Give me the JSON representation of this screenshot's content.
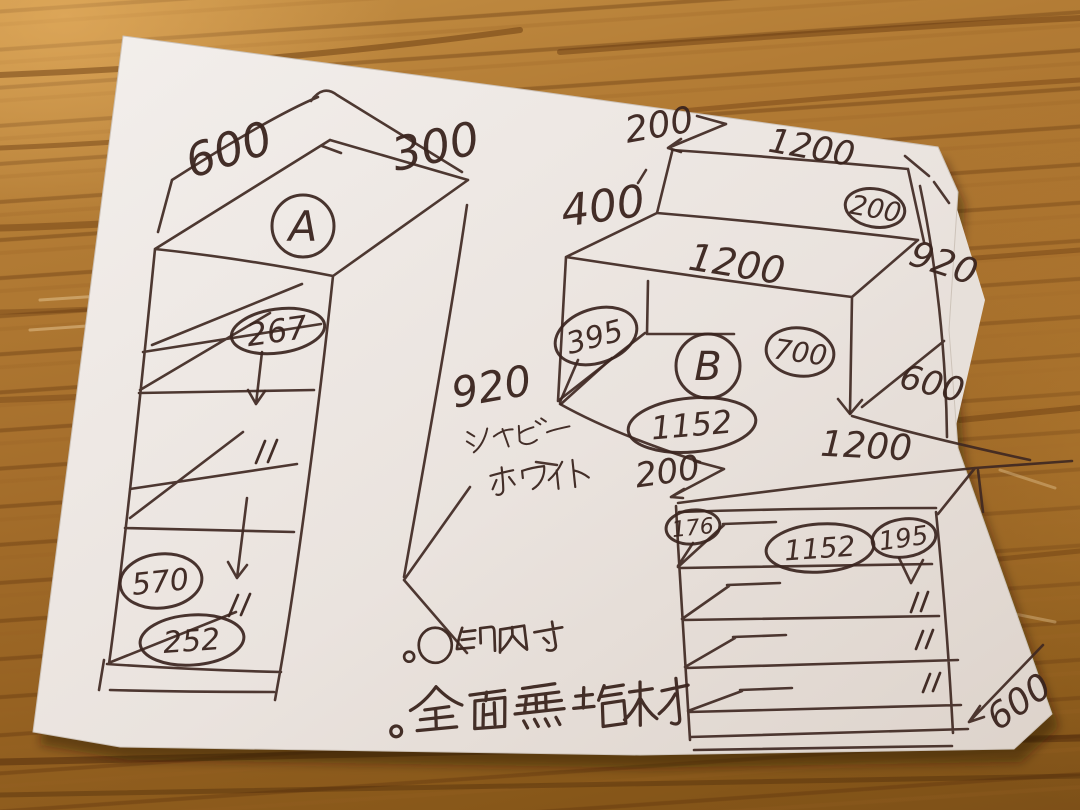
{
  "scene": {
    "ink_color": "#3f2822",
    "paper_color": "#ece6e1",
    "wood_color": "#a9742f"
  },
  "unit_a": {
    "label": "A",
    "top_width": "600",
    "top_depth": "300",
    "height": "920",
    "inner_heights": {
      "shelf1": "267",
      "shelf2_ditto": "〃",
      "shelf3_ditto": "〃",
      "shelf4": "570",
      "shelf5": "252"
    },
    "finish_line1": "シャビー",
    "finish_line2": "ホワイト"
  },
  "unit_b": {
    "label": "B",
    "top_setback": "200",
    "top_back_width": "1200",
    "top_thickness_circled": "200",
    "back_height": "400",
    "front_width": "1200",
    "height": "920",
    "inner_left_depth": "395",
    "inner_height_circled": "700",
    "depth": "600",
    "inner_width_circled": "1152"
  },
  "unit_c": {
    "top_setback": "200",
    "top_width": "1200",
    "inner_left_circled": "176",
    "inner_width_circled": "1152",
    "drawer_inner_height_circled": "195",
    "ditto_1": "〃",
    "ditto_2": "〃",
    "ditto_3": "〃",
    "depth": "600"
  },
  "notes": {
    "bullet_1": "。○印内寸",
    "bullet_2": "。全面無垢材"
  }
}
